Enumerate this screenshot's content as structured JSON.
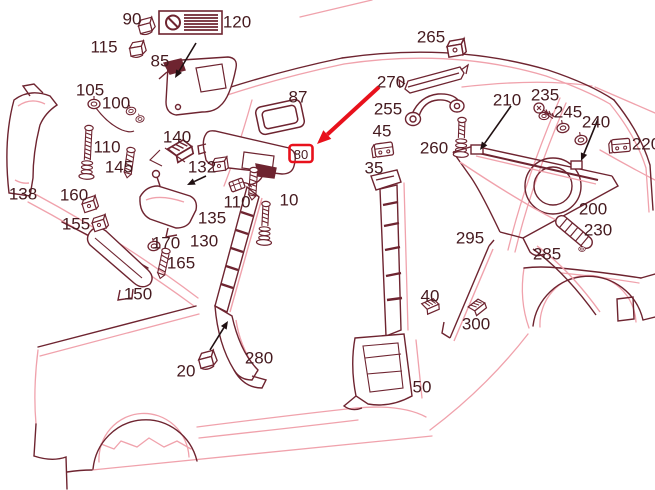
{
  "title": "vehicle-interior-trim-parts-diagram",
  "colors": {
    "dark": "#6e2430",
    "pink": "#f0a2ac",
    "black": "#201012",
    "red": "#e8111c",
    "text": "#451a1f",
    "bg": "#ffffff"
  },
  "highlight": {
    "label": "80",
    "box": {
      "x": 289.5,
      "y": 145,
      "w": 23,
      "h": 17
    },
    "arrow": {
      "x1": 379,
      "y1": 87,
      "x2": 317,
      "y2": 144
    }
  },
  "prohibition_plate": {
    "name": "no-smoking-style-plate",
    "stripes": 6
  },
  "labels": [
    {
      "text": "90",
      "x": 132,
      "y": 19
    },
    {
      "text": "120",
      "x": 237,
      "y": 22
    },
    {
      "text": "115",
      "x": 104,
      "y": 47
    },
    {
      "text": "85",
      "x": 160,
      "y": 61
    },
    {
      "text": "105",
      "x": 90,
      "y": 90
    },
    {
      "text": "100",
      "x": 116,
      "y": 103
    },
    {
      "text": "110",
      "x": 107,
      "y": 147
    },
    {
      "text": "140",
      "x": 177,
      "y": 137
    },
    {
      "text": "145",
      "x": 119,
      "y": 167
    },
    {
      "text": "132",
      "x": 202,
      "y": 167
    },
    {
      "text": "135",
      "x": 212,
      "y": 218
    },
    {
      "text": "130",
      "x": 204,
      "y": 241
    },
    {
      "text": "87",
      "x": 298,
      "y": 97
    },
    {
      "text": "138",
      "x": 23,
      "y": 194
    },
    {
      "text": "160",
      "x": 74,
      "y": 195
    },
    {
      "text": "155",
      "x": 76,
      "y": 224
    },
    {
      "text": "170",
      "x": 166,
      "y": 243
    },
    {
      "text": "165",
      "x": 181,
      "y": 263
    },
    {
      "text": "150",
      "x": 138,
      "y": 294
    },
    {
      "text": "110",
      "x": 237,
      "y": 202
    },
    {
      "text": "10",
      "x": 289,
      "y": 200
    },
    {
      "text": "20",
      "x": 186,
      "y": 371
    },
    {
      "text": "280",
      "x": 259,
      "y": 358
    },
    {
      "text": "265",
      "x": 431,
      "y": 37
    },
    {
      "text": "270",
      "x": 391,
      "y": 82
    },
    {
      "text": "255",
      "x": 388,
      "y": 109
    },
    {
      "text": "45",
      "x": 382,
      "y": 131
    },
    {
      "text": "260",
      "x": 434,
      "y": 148
    },
    {
      "text": "35",
      "x": 374,
      "y": 168
    },
    {
      "text": "210",
      "x": 507,
      "y": 100
    },
    {
      "text": "235",
      "x": 545,
      "y": 95
    },
    {
      "text": "245",
      "x": 568,
      "y": 112
    },
    {
      "text": "240",
      "x": 596,
      "y": 122
    },
    {
      "text": "220",
      "x": 646,
      "y": 144
    },
    {
      "text": "200",
      "x": 593,
      "y": 209
    },
    {
      "text": "230",
      "x": 598,
      "y": 230
    },
    {
      "text": "295",
      "x": 470,
      "y": 238
    },
    {
      "text": "285",
      "x": 547,
      "y": 254
    },
    {
      "text": "40",
      "x": 430,
      "y": 296
    },
    {
      "text": "300",
      "x": 476,
      "y": 324
    },
    {
      "text": "50",
      "x": 422,
      "y": 387
    }
  ],
  "black_arrows": [
    {
      "x1": 196,
      "y1": 43,
      "x2": 175,
      "y2": 78
    },
    {
      "x1": 206,
      "y1": 176,
      "x2": 187,
      "y2": 185
    },
    {
      "x1": 511,
      "y1": 106,
      "x2": 480,
      "y2": 150
    },
    {
      "x1": 598,
      "y1": 119,
      "x2": 581,
      "y2": 161
    },
    {
      "x1": 210,
      "y1": 350,
      "x2": 228,
      "y2": 321
    }
  ],
  "parts": [
    {
      "t": "clip",
      "x": 146,
      "y": 27,
      "r": -15,
      "s": 1
    },
    {
      "t": "clip",
      "x": 137,
      "y": 50,
      "r": -10,
      "s": 1
    },
    {
      "t": "grommet",
      "x": 94,
      "y": 104,
      "r": 0,
      "s": 1
    },
    {
      "t": "grommet",
      "x": 131,
      "y": 111,
      "r": -15,
      "s": 0.8
    },
    {
      "t": "grommet",
      "x": 140,
      "y": 119,
      "r": -15,
      "s": 0.7
    },
    {
      "t": "coilscrew",
      "x": 89,
      "y": 128,
      "r": 3,
      "s": 1,
      "len": 50
    },
    {
      "t": "screw",
      "x": 131,
      "y": 150,
      "r": 8,
      "s": 1,
      "len": 28
    },
    {
      "t": "ribbed",
      "x": 180,
      "y": 152,
      "r": -12,
      "s": 1.4
    },
    {
      "t": "cube",
      "x": 219,
      "y": 166,
      "r": -8,
      "s": 1
    },
    {
      "t": "connector",
      "x": 237,
      "y": 185,
      "r": -20,
      "s": 1
    },
    {
      "t": "screw",
      "x": 254,
      "y": 170,
      "r": 4,
      "s": 1,
      "len": 30
    },
    {
      "t": "coilscrew",
      "x": 266,
      "y": 204,
      "r": 3,
      "s": 1,
      "len": 40
    },
    {
      "t": "grommet",
      "x": 154,
      "y": 246,
      "r": -10,
      "s": 1
    },
    {
      "t": "screw",
      "x": 166,
      "y": 251,
      "r": 12,
      "s": 1,
      "len": 28
    },
    {
      "t": "cube",
      "x": 89,
      "y": 206,
      "r": -18,
      "s": 1
    },
    {
      "t": "cube",
      "x": 99,
      "y": 225,
      "r": -18,
      "s": 1
    },
    {
      "t": "clip",
      "x": 207,
      "y": 361,
      "r": -15,
      "s": 1.1
    },
    {
      "t": "cube",
      "x": 455,
      "y": 50,
      "r": -10,
      "s": 1.2
    },
    {
      "t": "bracket",
      "x": 384,
      "y": 150,
      "r": -8,
      "s": 1
    },
    {
      "t": "coilscrew",
      "x": 462,
      "y": 120,
      "r": 2,
      "s": 1,
      "len": 36
    },
    {
      "t": "nut",
      "x": 544,
      "y": 116,
      "r": 0,
      "s": 0.9
    },
    {
      "t": "sidescrew",
      "x": 539,
      "y": 108,
      "r": 0,
      "s": 1
    },
    {
      "t": "grommet",
      "x": 563,
      "y": 128,
      "r": -10,
      "s": 1
    },
    {
      "t": "grommet",
      "x": 581,
      "y": 140,
      "r": -10,
      "s": 1
    },
    {
      "t": "bracket",
      "x": 621,
      "y": 146,
      "r": -5,
      "s": 1
    },
    {
      "t": "ribbed",
      "x": 430,
      "y": 307,
      "r": -5,
      "s": 1
    },
    {
      "t": "ribbed",
      "x": 477,
      "y": 308,
      "r": -20,
      "s": 1
    },
    {
      "t": "nut",
      "x": 582,
      "y": 249,
      "r": 0,
      "s": 0.6
    }
  ]
}
